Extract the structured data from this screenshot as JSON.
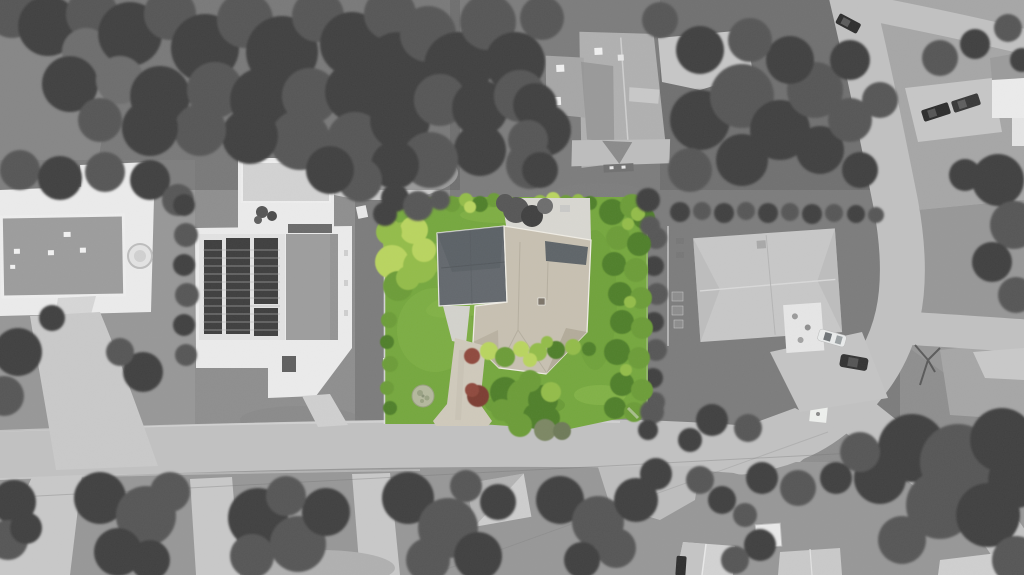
{
  "scene": {
    "type": "aerial-drone-photograph",
    "treatment": "grayscale neighborhood with subject property lot highlighted in color",
    "subject": "highlighted-property-lot",
    "objects": {
      "houses": [
        "west-white-mansion",
        "solar-panel-house",
        "north-gable-house",
        "east-ranch-house",
        "northeast-corner-house"
      ],
      "roads": [
        "main-street-bottom",
        "curving-street-right",
        "east-branch-street",
        "top-right-street"
      ],
      "vehicle_count": 6,
      "lot_features": [
        "beige-roof-house",
        "slate-roof-wing",
        "rear-patio",
        "front-driveway",
        "shrub-bed",
        "red-bushes",
        "stone-circle-in-lawn",
        "perimeter-hedges",
        "lime-green-tree"
      ],
      "road_features": [
        "white-utility-pad",
        "overhead-power-lines"
      ]
    }
  },
  "colors": {
    "ground_base": "#8e8e8e",
    "lawn_light": "#a6a6a6",
    "lawn_mid": "#979797",
    "lawn_dark": "#7c7c7c",
    "road": "#c1c1c1",
    "road_edge": "#d6d6d6",
    "driveway": "#c8c8c8",
    "concrete_light": "#d8d8d8",
    "tree_dark": "#404040",
    "tree_mid": "#565656",
    "tree_light": "#6d6d6d",
    "tree_pale": "#7e7e7e",
    "house_white": "#ebebeb",
    "roof_flat_gray": "#9c9c9c",
    "roof_light": "#c7c7c7",
    "roof_mid": "#b0b0b0",
    "solar_panel": "#3e3e3e",
    "lot_lawn": "#75a73e",
    "lot_lawn_light": "#8ebc4e",
    "lot_lawn_dark": "#619132",
    "hedge_dark": "#4f7f2a",
    "hedge_mid": "#6c9c38",
    "hedge_light": "#93bc49",
    "hedge_lime": "#b9d45e",
    "bush_red": "#8f4a3c",
    "bush_red2": "#7c3e33",
    "bush_fade1": "#7b8763",
    "bush_fade2": "#6e7a58",
    "lot_roof_beige": "#c7c0b1",
    "lot_roof_beige_dark": "#b3ab9a",
    "lot_roof_slate": "#63686d",
    "lot_roof_slate_dark": "#53585d",
    "lot_patio": "#d8d7d1",
    "lot_driveway": "#cfc9bb",
    "lawn_circle": "#b4b89d",
    "car_dark": "#2e2e2e",
    "car_white": "#e9ebeb",
    "fence_white": "#e3e3e3"
  }
}
